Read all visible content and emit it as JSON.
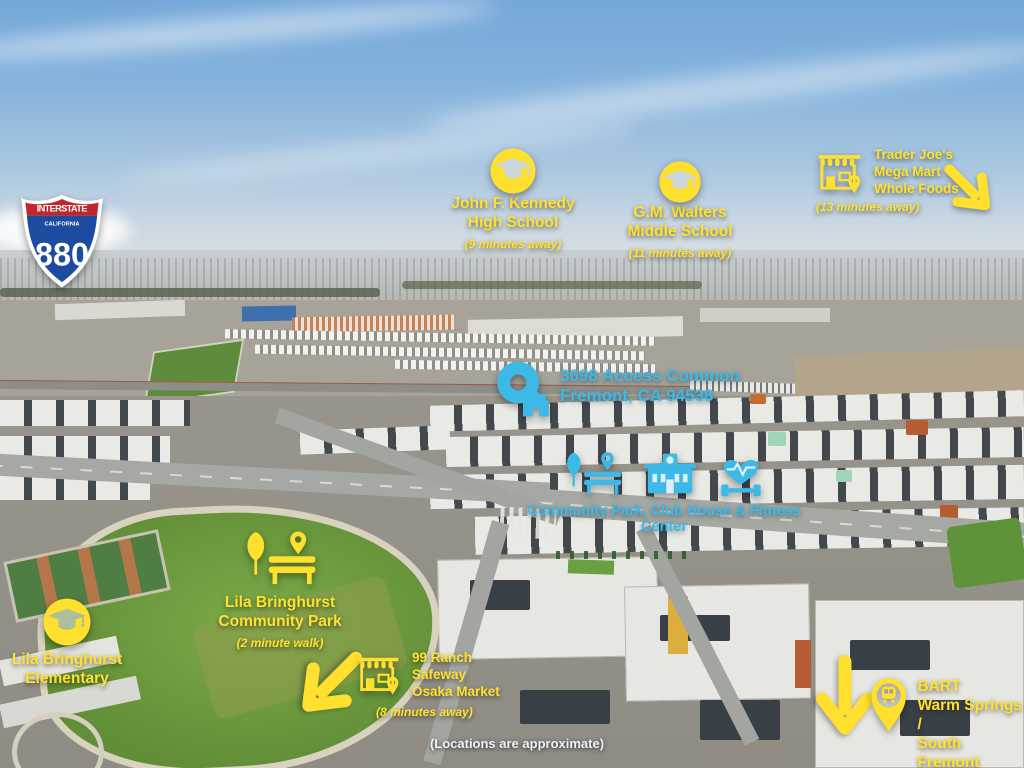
{
  "colors": {
    "yellow": "#ffe02e",
    "cyan": "#3cb9e7",
    "shield-red": "#c0272d",
    "shield-blue": "#1d4b9f",
    "white": "#eef2f4"
  },
  "shield": {
    "top": "INTERSTATE",
    "state": "CALIFORNIA",
    "number": "880"
  },
  "locations": {
    "jfk": {
      "line1": "John F. Kennedy",
      "line2": "High School",
      "distance": "(9 minutes away)"
    },
    "walters": {
      "line1": "G.M. Walters",
      "line2": "Middle School",
      "distance": "(11 minutes away)"
    },
    "trader": {
      "line1": "Trader Joe's",
      "line2": "Mega Mart",
      "line3": "Whole Foods",
      "distance": "(13 minutes away)"
    },
    "address": {
      "line1": "3698 Access Common",
      "line2": "Fremont, CA 94538"
    },
    "community": {
      "label": "Community Park, Club House & Fitness Center"
    },
    "park": {
      "line1": "Lila Bringhurst",
      "line2": "Community Park",
      "distance": "(2 minute walk)"
    },
    "elementary": {
      "line1": "Lila Bringhurst",
      "line2": "Elementary"
    },
    "ranch": {
      "line1": "99 Ranch",
      "line2": "Safeway",
      "line3": "Osaka Market",
      "distance": "(8 minutes away)"
    },
    "bart": {
      "line1": "BART",
      "line2": "Warm Springs /",
      "line3": "South Fremont",
      "distance": "(3 minutes away)"
    }
  },
  "disclaimer": "(Locations are approximate)",
  "icons": {
    "jfk": "graduation-cap-circle-icon",
    "walters": "graduation-cap-circle-icon",
    "elementary": "graduation-cap-circle-icon",
    "trader": "storefront-pin-icon",
    "ranch": "storefront-pin-icon",
    "address": "home-pin-icon",
    "park": "tree-bench-pin-icon",
    "community": [
      "tree-bench-pin-icon",
      "clubhouse-icon",
      "fitness-heart-dumbbell-icon"
    ],
    "bart": "train-pin-icon",
    "arrows": [
      "arrow-down-right",
      "arrow-down-left",
      "arrow-down"
    ]
  }
}
